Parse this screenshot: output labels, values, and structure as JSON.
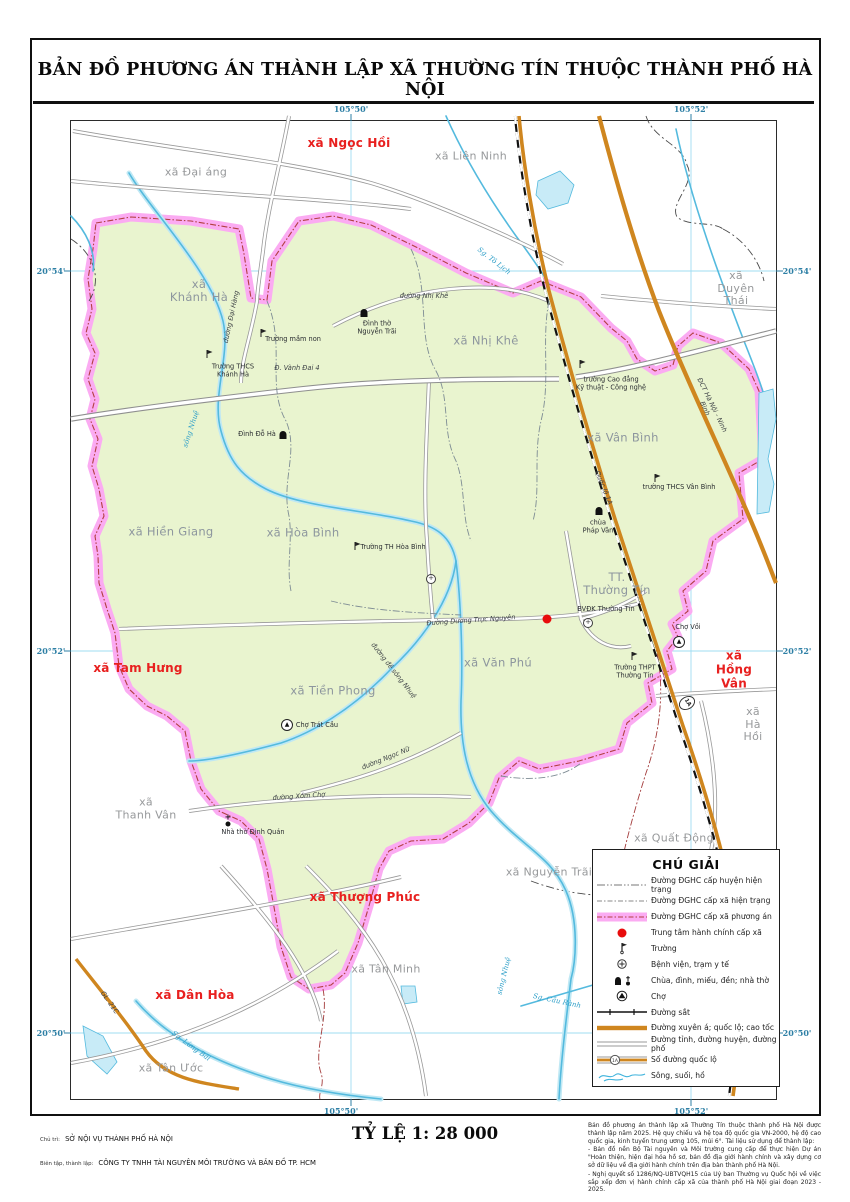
{
  "title": "BẢN ĐỒ PHƯƠNG ÁN THÀNH LẬP XÃ THƯỜNG TÍN THUỘC THÀNH PHỐ HÀ NỘI",
  "scale_label": "TỶ LỆ 1: 28 000",
  "credits": {
    "line1_label": "Chủ trì:",
    "line1_value": "SỞ NỘI VỤ THÀNH PHỐ HÀ NỘI",
    "line2_label": "Biên tập, thành lập:",
    "line2_value": "CÔNG TY TNHH TÀI NGUYÊN MÔI TRƯỜNG VÀ BẢN ĐỒ TP. HCM"
  },
  "notes": [
    "Bản đồ phương án thành lập xã Thường Tín thuộc thành phố Hà Nội được thành lập năm 2025. Hệ quy chiếu và hệ tọa độ quốc gia VN-2000, hệ độ cao quốc gia, kinh tuyến trung ương 105, múi 6°. Tài liệu sử dụng để thành lập:",
    "- Bản đồ nền Bộ Tài nguyên và Môi trường cung cấp để thực hiện Dự án \"Hoàn thiện, hiện đại hóa hồ sơ, bản đồ địa giới hành chính và xây dựng cơ sở dữ liệu về địa giới hành chính trên địa bàn thành phố Hà Nội.",
    "- Nghị quyết số 1286/NQ-UBTVQH15 của Uỷ ban Thường vụ Quốc hội về việc sắp xếp đơn vị hành chính cấp xã của thành phố Hà Nội giai đoạn 2023 - 2025."
  ],
  "legend": {
    "title": "CHÚ GIẢI",
    "items": [
      {
        "symbol": "boundary-district",
        "label": "Đường ĐGHC cấp huyện hiện trạng"
      },
      {
        "symbol": "boundary-commune",
        "label": "Đường ĐGHC cấp xã hiện trạng"
      },
      {
        "symbol": "boundary-plan",
        "label": "Đường ĐGHC cấp xã phương án"
      },
      {
        "symbol": "center",
        "label": "Trung tâm hành chính cấp xã"
      },
      {
        "symbol": "school",
        "label": "Trường"
      },
      {
        "symbol": "hospital",
        "label": "Bệnh viện, trạm y tế"
      },
      {
        "symbol": "temple",
        "label": "Chùa, đình, miếu, đền; nhà thờ"
      },
      {
        "symbol": "market",
        "label": "Chợ"
      },
      {
        "symbol": "railway",
        "label": "Đường sắt"
      },
      {
        "symbol": "highway",
        "label": "Đường xuyên á; quốc lộ; cao tốc"
      },
      {
        "symbol": "road",
        "label": "Đường tỉnh, đường huyện, đường phố"
      },
      {
        "symbol": "road-number",
        "label": "Số đường quốc lộ",
        "shield_text": "1A"
      },
      {
        "symbol": "water",
        "label": "Sông, suối, hồ"
      }
    ]
  },
  "map": {
    "colors": {
      "commune_fill": "#e9f4cf",
      "boundary_pink": "#fbabf2",
      "highway_orange": "#cf861f",
      "water_blue": "#54bade",
      "admin_center_red": "#e80c0c",
      "label_red": "#e8201f",
      "coordinate_blue": "#2d7fa5"
    },
    "coordinates": {
      "top": [
        {
          "text": "105°50'",
          "x": 280
        },
        {
          "text": "105°52'",
          "x": 620
        }
      ],
      "bottom": [
        {
          "text": "105°50'",
          "x": 270
        },
        {
          "text": "105°52'",
          "x": 620
        }
      ],
      "left": [
        {
          "text": "20°54'",
          "y": 150
        },
        {
          "text": "20°52'",
          "y": 530
        },
        {
          "text": "20°50'",
          "y": 912
        }
      ],
      "right": [
        {
          "text": "20°54'",
          "y": 150
        },
        {
          "text": "20°52'",
          "y": 530
        },
        {
          "text": "20°50'",
          "y": 912
        }
      ]
    },
    "labels": [
      {
        "name": "label-xa-ngoc-hoi",
        "text": "xã Ngọc Hồi",
        "cls": "red",
        "x": 278,
        "y": 23
      },
      {
        "name": "label-xa-dai-ang",
        "text": "xã Đại áng",
        "cls": "gray",
        "x": 125,
        "y": 52
      },
      {
        "name": "label-xa-lien-ninh",
        "text": "xã Liên Ninh",
        "cls": "gray",
        "x": 400,
        "y": 36
      },
      {
        "name": "label-xa-duyen-thai",
        "text": "xã Duyên Thái",
        "cls": "gray",
        "x": 665,
        "y": 168
      },
      {
        "name": "label-xa-khanh-ha",
        "text": "xã\nKhánh Hà",
        "cls": "inside",
        "x": 128,
        "y": 170
      },
      {
        "name": "label-xa-nhi-khe",
        "text": "xã Nhị Khê",
        "cls": "inside",
        "x": 415,
        "y": 220
      },
      {
        "name": "label-xa-van-binh",
        "text": "xã Vân Bình",
        "cls": "inside",
        "x": 552,
        "y": 317
      },
      {
        "name": "label-xa-hien-giang",
        "text": "xã Hiền Giang",
        "cls": "inside",
        "x": 100,
        "y": 411
      },
      {
        "name": "label-xa-hoa-binh",
        "text": "xã Hòa Bình",
        "cls": "inside",
        "x": 232,
        "y": 412
      },
      {
        "name": "label-tt-thuong-tin",
        "text": "TT.\nThường Tín",
        "cls": "inside",
        "x": 546,
        "y": 463
      },
      {
        "name": "label-xa-van-phu",
        "text": "xã Văn Phú",
        "cls": "inside",
        "x": 427,
        "y": 542
      },
      {
        "name": "label-xa-tien-phong",
        "text": "xã Tiền Phong",
        "cls": "inside",
        "x": 262,
        "y": 570
      },
      {
        "name": "label-xa-tam-hung",
        "text": "xã Tam Hưng",
        "cls": "red",
        "x": 67,
        "y": 548
      },
      {
        "name": "label-xa-hong-van",
        "text": "xã Hồng Vân",
        "cls": "red",
        "x": 663,
        "y": 549
      },
      {
        "name": "label-xa-ha-hoi",
        "text": "xã Hà Hồi",
        "cls": "gray",
        "x": 682,
        "y": 604
      },
      {
        "name": "label-xa-quat-dong",
        "text": "xã Quất Động",
        "cls": "gray",
        "x": 603,
        "y": 718
      },
      {
        "name": "label-xa-nguyen-trai",
        "text": "xã Nguyễn Trãi",
        "cls": "gray",
        "x": 478,
        "y": 752
      },
      {
        "name": "label-xa-tan-minh",
        "text": "xã Tân Minh",
        "cls": "gray",
        "x": 315,
        "y": 849
      },
      {
        "name": "label-xa-thanh-van",
        "text": "xã\nThanh Vân",
        "cls": "gray",
        "x": 75,
        "y": 688
      },
      {
        "name": "label-xa-thuong-phuc",
        "text": "xã Thượng Phúc",
        "cls": "red",
        "x": 294,
        "y": 777
      },
      {
        "name": "label-xa-dan-hoa",
        "text": "xã Dân Hòa",
        "cls": "red",
        "x": 124,
        "y": 875
      },
      {
        "name": "label-xa-tan-uoc",
        "text": "xã Tân Ước",
        "cls": "gray",
        "x": 100,
        "y": 948
      },
      {
        "name": "label-duong-nhi-khe",
        "text": "đường Nhị Khê",
        "cls": "roadname",
        "x": 353,
        "y": 176
      },
      {
        "name": "label-dinh-tho-nguyen-trai",
        "text": "Đình thờ\nNguyễn Trãi",
        "cls": "poi",
        "x": 306,
        "y": 207
      },
      {
        "name": "label-truong-mam-non",
        "text": "Trường mầm non",
        "cls": "poi",
        "x": 222,
        "y": 219
      },
      {
        "name": "label-truong-thcs-khanh-ha",
        "text": "Trường THCS\nKhánh Hà",
        "cls": "poi",
        "x": 162,
        "y": 250
      },
      {
        "name": "label-d-vanh-dai-4",
        "text": "Đ. Vành Đai 4",
        "cls": "roadname",
        "x": 226,
        "y": 248
      },
      {
        "name": "label-dinh-do-ha",
        "text": "Đình Đỗ Hà",
        "cls": "poi",
        "x": 186,
        "y": 314
      },
      {
        "name": "label-duong-dai-hang",
        "text": "đường Đại Hàng",
        "cls": "roadname",
        "x": 161,
        "y": 196,
        "rot": -78
      },
      {
        "name": "label-song-nhue-upper",
        "text": "sông Nhuệ",
        "cls": "water",
        "x": 120,
        "y": 308,
        "rot": -72
      },
      {
        "name": "label-truong-th-hoa-binh",
        "text": "Trường TH Hòa Bình",
        "cls": "poi",
        "x": 322,
        "y": 427
      },
      {
        "name": "label-truong-cao-dang",
        "text": "trường Cao đẳng\nKỹ thuật - Công nghệ",
        "cls": "poi",
        "x": 540,
        "y": 263
      },
      {
        "name": "label-truong-thcs-van-binh",
        "text": "trường THCS Vân Bình",
        "cls": "poi",
        "x": 608,
        "y": 367
      },
      {
        "name": "label-chua-phap-van",
        "text": "chùa\nPháp Vân",
        "cls": "poi",
        "x": 527,
        "y": 406
      },
      {
        "name": "label-quoc-lo-1a",
        "text": "Quốc lộ 1A",
        "cls": "roadname",
        "x": 532,
        "y": 367,
        "rot": 68
      },
      {
        "name": "label-dct-ha-noi-ninh-binh",
        "text": "ĐCT Hà Nội - Ninh Bình",
        "cls": "roadname",
        "x": 637,
        "y": 286,
        "rot": 64
      },
      {
        "name": "label-bvdk-thuong-tin",
        "text": "BVĐK Thường Tín",
        "cls": "poi",
        "x": 535,
        "y": 489
      },
      {
        "name": "label-duong-duong-truc-nguyen",
        "text": "Đường Dương Trực Nguyên",
        "cls": "roadname",
        "x": 400,
        "y": 500,
        "rot": -4
      },
      {
        "name": "label-truong-thpt-thuong-tin",
        "text": "Trường THPT\nThường Tín",
        "cls": "poi",
        "x": 564,
        "y": 551
      },
      {
        "name": "label-cho-voi",
        "text": "Chợ Vồi",
        "cls": "poi",
        "x": 617,
        "y": 507
      },
      {
        "name": "label-cho-trat-cau",
        "text": "Chợ Trát Cầu",
        "cls": "poi",
        "x": 246,
        "y": 605
      },
      {
        "name": "label-duong-ngoc-nu",
        "text": "đường Ngọc Nữ",
        "cls": "roadname",
        "x": 315,
        "y": 638,
        "rot": -22
      },
      {
        "name": "label-duong-xom-cho",
        "text": "đường Xóm Chợ",
        "cls": "roadname",
        "x": 228,
        "y": 676,
        "rot": -4
      },
      {
        "name": "label-nha-tho-dinh-quan",
        "text": "Nhà thờ Định Quán",
        "cls": "poi",
        "x": 182,
        "y": 712
      },
      {
        "name": "label-duong-de-song-nhue",
        "text": "đường đê sông Nhuệ",
        "cls": "roadname",
        "x": 322,
        "y": 550,
        "rot": 52
      },
      {
        "name": "label-sg-to-lich",
        "text": "Sg. Tô Lịch",
        "cls": "water",
        "x": 423,
        "y": 140,
        "rot": 38
      },
      {
        "name": "label-gl-21c",
        "text": "GL. 21C",
        "cls": "roadname",
        "x": 38,
        "y": 882,
        "rot": 55
      },
      {
        "name": "label-sg-lung-bai",
        "text": "Sg. Lừng Bãi",
        "cls": "water",
        "x": 120,
        "y": 925,
        "rot": 36
      },
      {
        "name": "label-sg-cau-ranh",
        "text": "Sg. Cầu Rành",
        "cls": "water",
        "x": 486,
        "y": 880,
        "rot": 12
      },
      {
        "name": "label-song-nhue-lower",
        "text": "sông Nhuệ",
        "cls": "water",
        "x": 433,
        "y": 855,
        "rot": -76
      }
    ],
    "symbols": [
      {
        "type": "red-dot",
        "name": "commune-center-symbol",
        "x": 476,
        "y": 498
      },
      {
        "type": "hospital",
        "name": "hospital-symbol-bvdk",
        "x": 517,
        "y": 502
      },
      {
        "type": "hospital",
        "name": "hospital-symbol-hoa-binh",
        "x": 360,
        "y": 458
      },
      {
        "type": "school",
        "name": "school-symbol-mam-non",
        "x": 193,
        "y": 213
      },
      {
        "type": "school",
        "name": "school-symbol-thcs-khanh-ha",
        "x": 139,
        "y": 234
      },
      {
        "type": "school",
        "name": "school-symbol-cao-dang",
        "x": 512,
        "y": 244
      },
      {
        "type": "school",
        "name": "school-symbol-thcs-van-binh",
        "x": 587,
        "y": 358
      },
      {
        "type": "school",
        "name": "school-symbol-th-hoa-binh",
        "x": 287,
        "y": 426
      },
      {
        "type": "school",
        "name": "school-symbol-thpt",
        "x": 564,
        "y": 536
      },
      {
        "type": "temple",
        "name": "temple-symbol-nguyen-trai",
        "x": 293,
        "y": 192
      },
      {
        "type": "temple",
        "name": "temple-symbol-do-ha",
        "x": 212,
        "y": 314
      },
      {
        "type": "temple",
        "name": "temple-symbol-phap-van",
        "x": 528,
        "y": 390
      },
      {
        "type": "church",
        "name": "church-symbol-dinh-quan",
        "x": 157,
        "y": 699
      },
      {
        "type": "market",
        "name": "market-symbol-cho-voi",
        "x": 608,
        "y": 521
      },
      {
        "type": "market",
        "name": "market-symbol-trat-cau",
        "x": 216,
        "y": 604
      },
      {
        "type": "shield",
        "name": "route-shield-1a",
        "x": 616,
        "y": 582,
        "text": "1A",
        "rot": 60
      }
    ]
  }
}
